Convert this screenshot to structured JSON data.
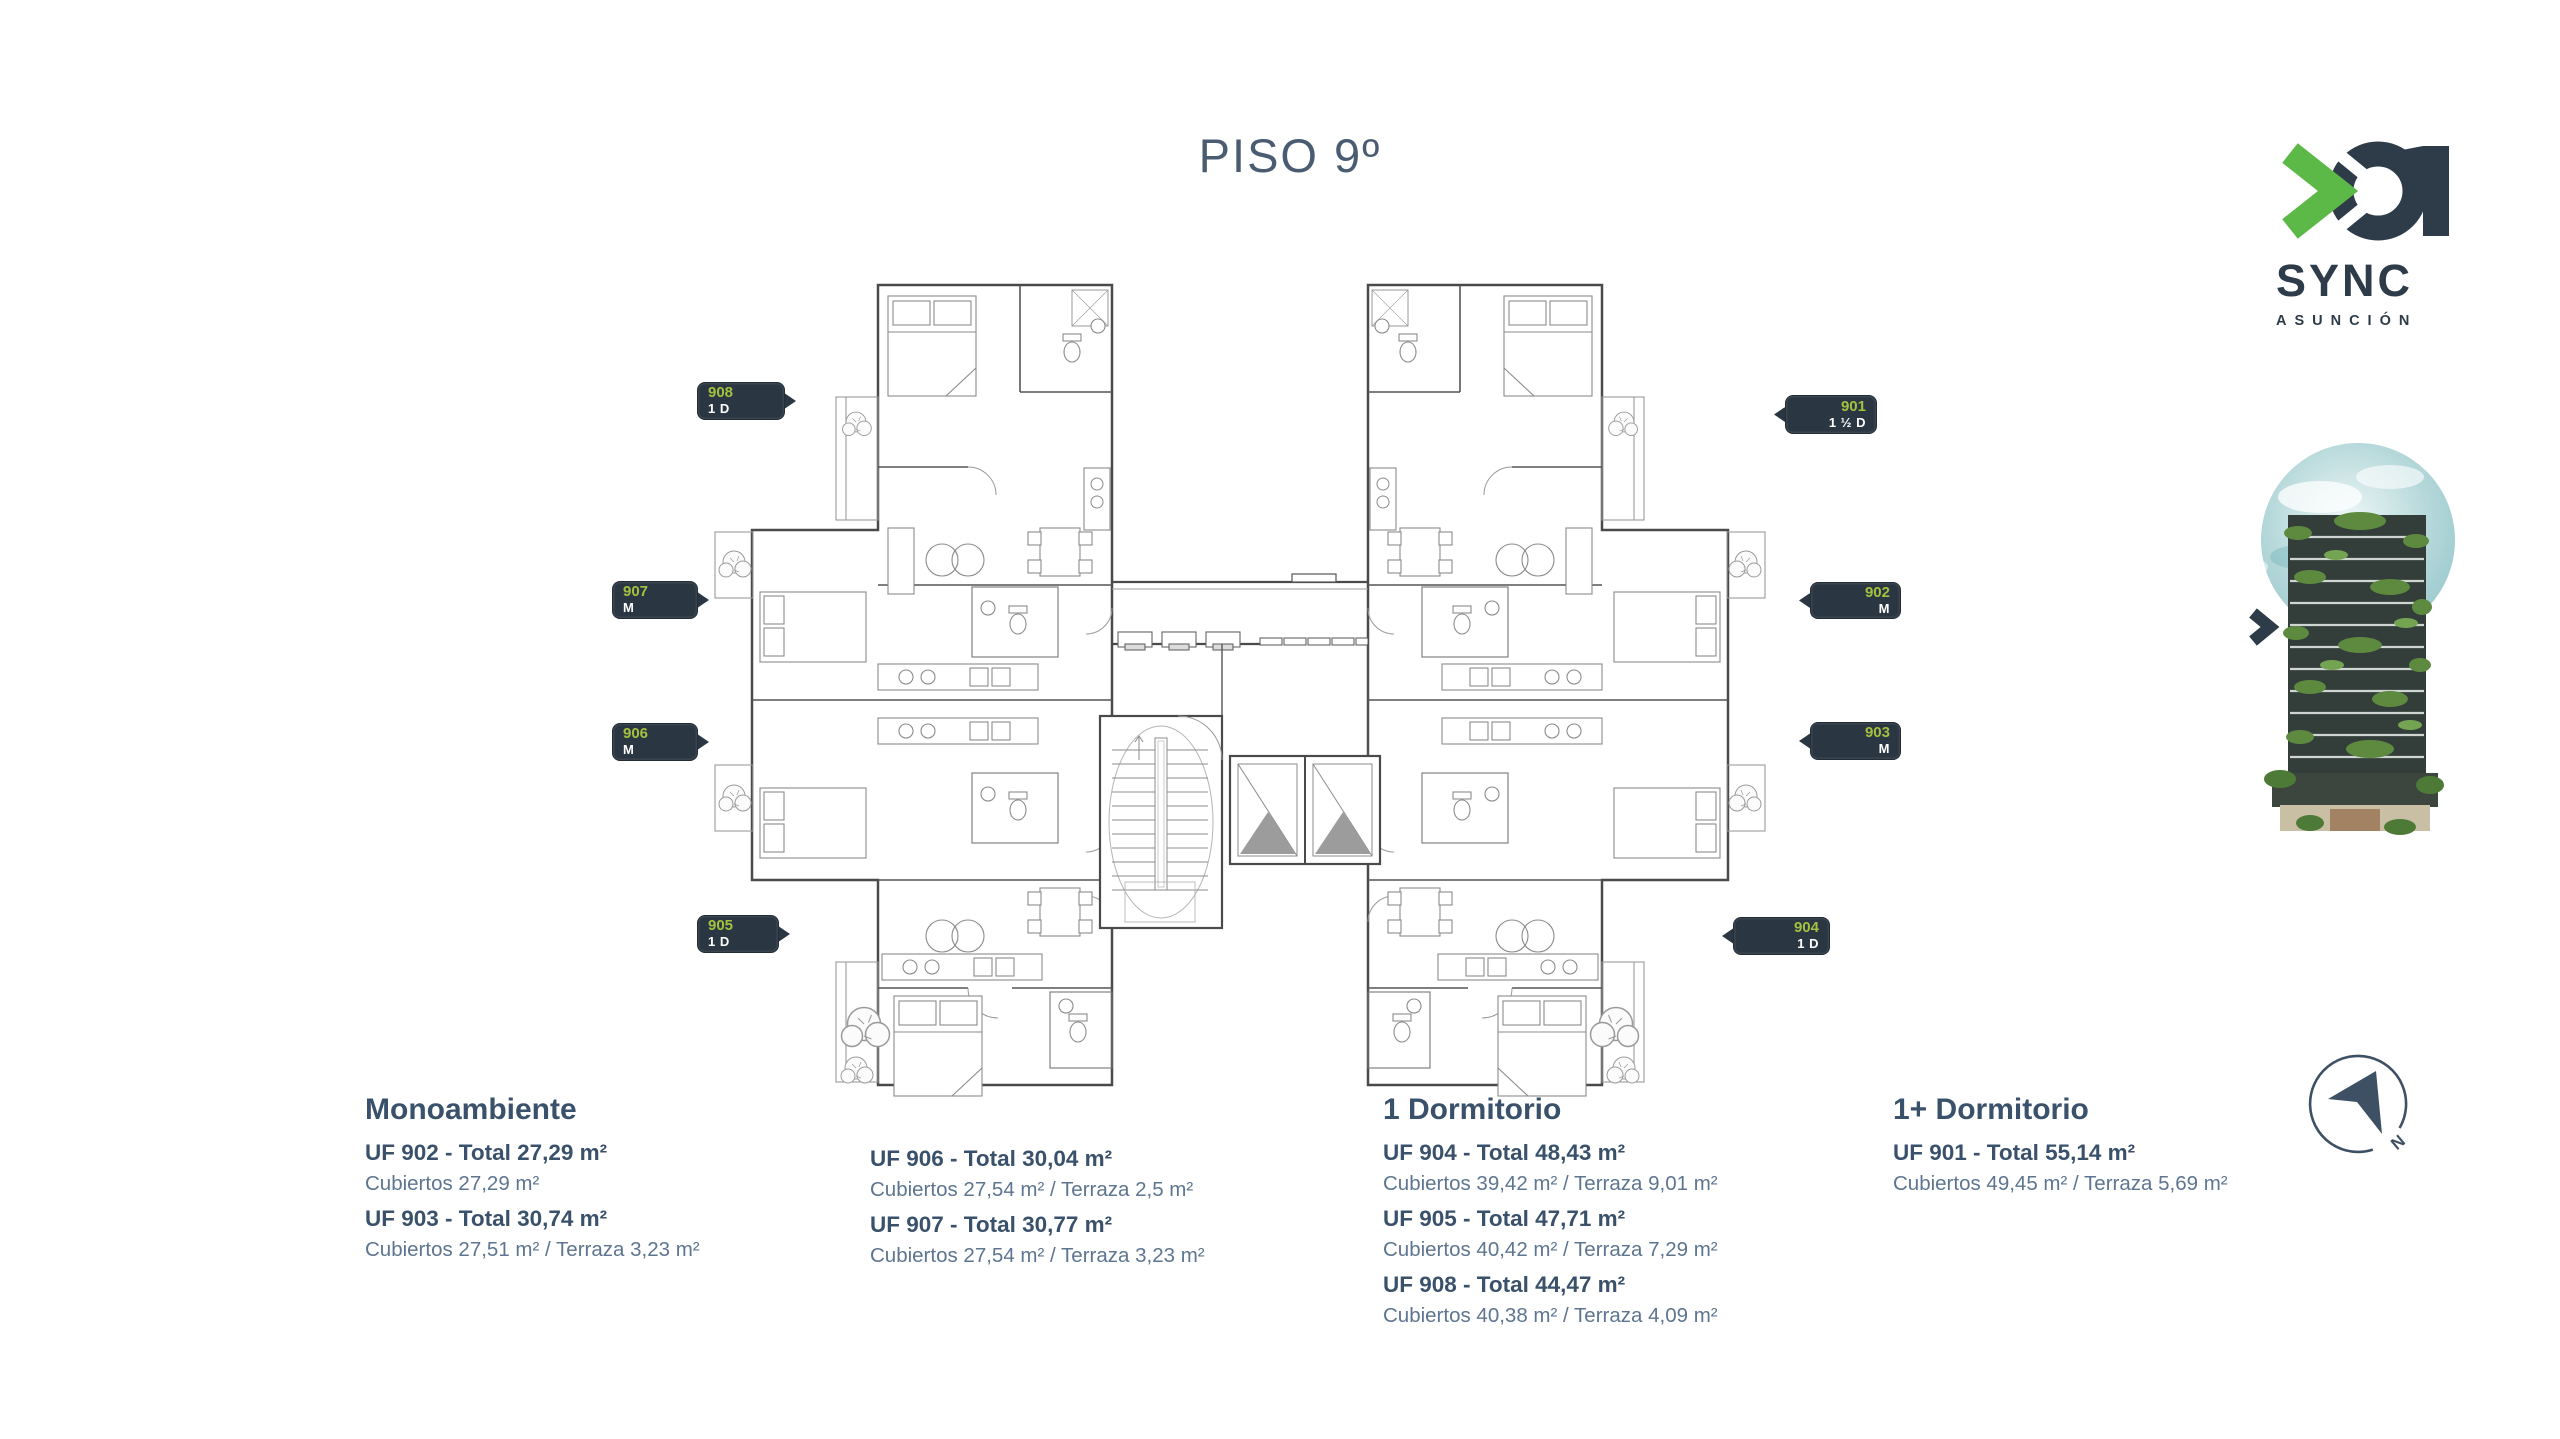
{
  "page": {
    "title": "PISO 9º"
  },
  "logo": {
    "mark": "01",
    "name": "SYNC",
    "city": "ASUNCIÓN",
    "accent_green": "#5cb847",
    "navy": "#2e3b48"
  },
  "plan": {
    "tags": [
      {
        "number": "908",
        "type": "1 D"
      },
      {
        "number": "907",
        "type": "M"
      },
      {
        "number": "906",
        "type": "M"
      },
      {
        "number": "905",
        "type": "1 D"
      },
      {
        "number": "901",
        "type": "1 ½ D"
      },
      {
        "number": "902",
        "type": "M"
      },
      {
        "number": "903",
        "type": "M"
      },
      {
        "number": "904",
        "type": "1 D"
      }
    ]
  },
  "legend": {
    "columns": [
      {
        "heading": "Monoambiente",
        "units": [
          {
            "title": "UF 902 - Total 27,29 m²",
            "detail": "Cubiertos 27,29 m²"
          },
          {
            "title": "UF 903 - Total 30,74 m²",
            "detail": "Cubiertos 27,51 m² / Terraza 3,23 m²"
          }
        ]
      },
      {
        "heading": "",
        "units": [
          {
            "title": "UF 906 - Total 30,04 m²",
            "detail": "Cubiertos 27,54 m² / Terraza 2,5 m²"
          },
          {
            "title": "UF 907 - Total 30,77 m²",
            "detail": "Cubiertos 27,54 m² / Terraza 3,23 m²"
          }
        ]
      },
      {
        "heading": "1 Dormitorio",
        "units": [
          {
            "title": "UF 904 - Total  48,43 m²",
            "detail": "Cubiertos 39,42 m² / Terraza 9,01 m²"
          },
          {
            "title": "UF 905 - Total 47,71 m²",
            "detail": "Cubiertos 40,42 m² / Terraza 7,29 m²"
          },
          {
            "title": "UF 908 - Total 44,47 m²",
            "detail": "Cubiertos 40,38 m² / Terraza 4,09 m²"
          }
        ]
      },
      {
        "heading": "1+ Dormitorio",
        "units": [
          {
            "title": "UF 901 - Total 55,14 m²",
            "detail": "Cubiertos 49,45 m² / Terraza 5,69 m²"
          }
        ]
      }
    ]
  },
  "compass": {
    "label": "N"
  }
}
